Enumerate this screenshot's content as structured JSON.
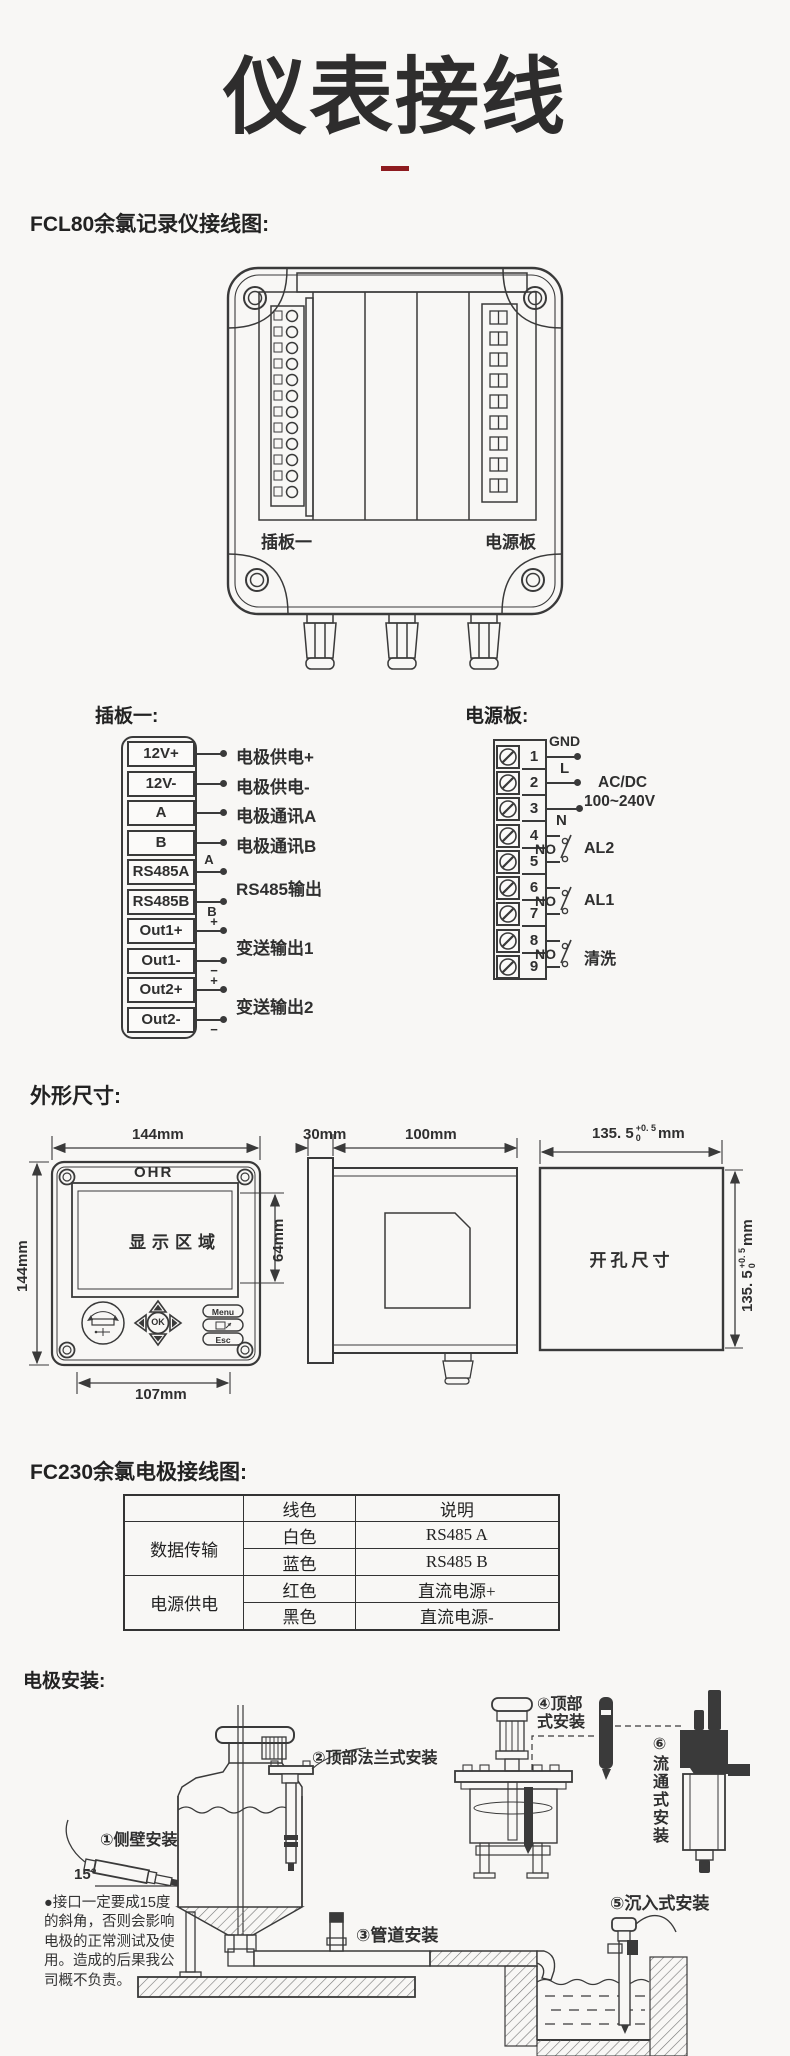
{
  "page": {
    "bg": "#f8f7f5",
    "ink": "#3a3a3a",
    "accent": "#8e1b1f"
  },
  "title": "仪表接线",
  "headings": {
    "fcl80": "FCL80余氯记录仪接线图:",
    "dims": "外形尺寸:",
    "fc230": "FC230余氯电极接线图:",
    "install": "电极安装:"
  },
  "device_rear": {
    "left_label": "插板一",
    "right_label": "电源板"
  },
  "plugboard": {
    "heading": "插板一:",
    "terminals": [
      "12V+",
      "12V-",
      "A",
      "B",
      "RS485A",
      "RS485B",
      "Out1+",
      "Out1-",
      "Out2+",
      "Out2-"
    ],
    "marks": {
      "a": "A",
      "b": "B",
      "plus": "+",
      "minus": "−"
    },
    "outputs": {
      "supply_pos": "电极供电+",
      "supply_neg": "电极供电-",
      "comm_a": "电极通讯A",
      "comm_b": "电极通讯B",
      "rs485": "RS485输出",
      "out1": "变送输出1",
      "out2": "变送输出2"
    }
  },
  "powerboard": {
    "heading": "电源板:",
    "numbers": [
      "1",
      "2",
      "3",
      "4",
      "5",
      "6",
      "7",
      "8",
      "9"
    ],
    "gnd": "GND",
    "live": "L",
    "neutral": "N",
    "acdc1": "AC/DC",
    "acdc2": "100~240V",
    "no": "NO",
    "al2": "AL2",
    "al1": "AL1",
    "wash": "清洗"
  },
  "dims": {
    "front_w": "144mm",
    "front_h": "144mm",
    "brand": "OHR",
    "display": "显示区域",
    "display_h": "64mm",
    "bottom_w": "107mm",
    "ok": "OK",
    "menu": "Menu",
    "esc": "Esc",
    "side_bezel": "30mm",
    "side_depth": "100mm",
    "cutout_label": "开孔尺寸",
    "cutout_main": "135. 5",
    "cutout_tol_top": "+0. 5",
    "cutout_tol_bottom": "0",
    "cutout_unit": "mm"
  },
  "fc230_table": {
    "headers": [
      "",
      "线色",
      "说明"
    ],
    "group1": {
      "name": "数据传输",
      "r1c1": "白色",
      "r1c2": "RS485 A",
      "r2c1": "蓝色",
      "r2c2": "RS485 B"
    },
    "group2": {
      "name": "电源供电",
      "r1c1": "红色",
      "r1c2": "直流电源+",
      "r2c1": "黑色",
      "r2c2": "直流电源-"
    }
  },
  "install": {
    "l1": "①侧壁安装",
    "l2": "②顶部法兰式安装",
    "l3": "③管道安装",
    "l4": "④顶部式安装",
    "l5": "⑤沉入式安装",
    "l6": "⑥流通式安装",
    "angle": "15°",
    "note": "●接口一定要成15度的斜角，否则会影响电极的正常测试及使用。造成的后果我公司概不负责。"
  }
}
